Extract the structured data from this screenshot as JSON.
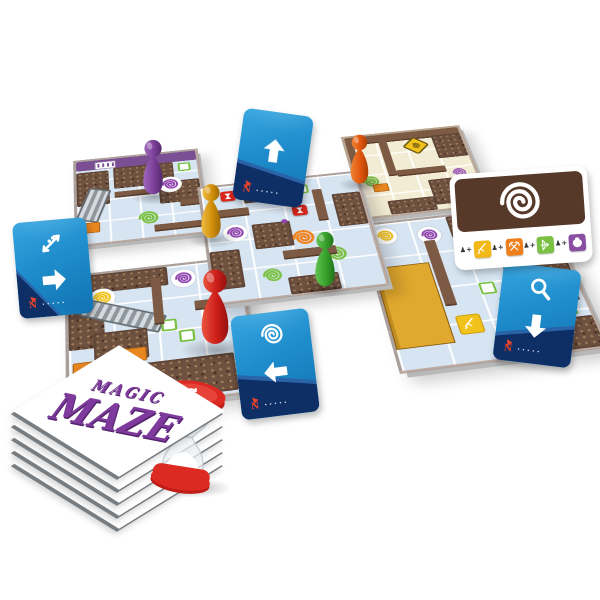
{
  "logo": {
    "line1": "MAGIC",
    "line2": "MAZE",
    "color": "#7e3a9c"
  },
  "palette": {
    "card_blue": "#1f8fd0",
    "card_navy": "#0e2f66",
    "tile_blue": "#d7e5f2",
    "tile_cream": "#f3ecd4",
    "wall_brown": "#7d5a44",
    "crowd_brown": "#6f5140",
    "swirl_purple": "#8e44ad",
    "swirl_green": "#7ac143",
    "swirl_orange": "#f0821e",
    "swirl_yellow": "#f2c21c",
    "hourglass_red": "#d9261c",
    "shop_gold": "#e0a82e",
    "timer_red": "#dc2a22",
    "logo_purple": "#7e3a9c"
  },
  "action_cards": [
    {
      "id": "move-up",
      "icons": [
        {
          "n": "arrow",
          "dir": 0
        }
      ],
      "compass": "N",
      "fine_print": "•••••",
      "x": 238,
      "y": 112,
      "w": 70,
      "h": 92,
      "rot": 8,
      "navy": "slope-right"
    },
    {
      "id": "escalator-move-right",
      "icons": [
        {
          "n": "escalator"
        },
        {
          "n": "arrow",
          "dir": 90
        }
      ],
      "compass": "N",
      "fine_print": "•••••",
      "x": 16,
      "y": 220,
      "w": 74,
      "h": 96,
      "rot": -5,
      "navy": "corner"
    },
    {
      "id": "search-move-down",
      "icons": [
        {
          "n": "magnifier"
        },
        {
          "n": "arrow",
          "dir": 180
        }
      ],
      "compass": "N",
      "fine_print": "•••••",
      "x": 498,
      "y": 266,
      "w": 78,
      "h": 98,
      "rot": 7,
      "navy": "slope-left"
    },
    {
      "id": "vortex-move-left",
      "icons": [
        {
          "n": "vortex"
        },
        {
          "n": "arrow",
          "dir": 270
        }
      ],
      "compass": "N",
      "fine_print": "•••••",
      "x": 236,
      "y": 312,
      "w": 78,
      "h": 104,
      "rot": -7,
      "navy": "slope-right"
    }
  ],
  "spell_card": {
    "x": 452,
    "y": 170,
    "w": 138,
    "h": 96,
    "rot": -4,
    "top_icon": "vortex",
    "brown": "#57392a",
    "prefix": "♟+",
    "items": [
      {
        "icon": "sword",
        "color": "#f2b818"
      },
      {
        "icon": "axes",
        "color": "#ee7f1b"
      },
      {
        "icon": "bow",
        "color": "#7ac143"
      },
      {
        "icon": "flask",
        "color": "#8a4fa3"
      }
    ]
  },
  "pawns": [
    {
      "name": "purple",
      "main": "#7b3f98",
      "light": "#a169bd",
      "dark": "#55286e",
      "x": 138,
      "y": 138,
      "w": 30,
      "h": 60
    },
    {
      "name": "orange",
      "main": "#e0560b",
      "light": "#f08335",
      "dark": "#aa3e04",
      "x": 346,
      "y": 133,
      "w": 27,
      "h": 54
    },
    {
      "name": "gold",
      "main": "#d28f0a",
      "light": "#eebd46",
      "dark": "#9e6a04",
      "x": 196,
      "y": 183,
      "w": 30,
      "h": 58
    },
    {
      "name": "green",
      "main": "#37a02c",
      "light": "#66c253",
      "dark": "#1f741a",
      "x": 310,
      "y": 230,
      "w": 30,
      "h": 60
    },
    {
      "name": "red",
      "main": "#cd1f1a",
      "light": "#ea5540",
      "dark": "#931110",
      "x": 193,
      "y": 268,
      "w": 44,
      "h": 80
    }
  ],
  "timer": {
    "icon": "cycle-arrows",
    "cap_color": "#dc2a22",
    "cap_dark": "#c01d18",
    "cap_light": "#e8433a",
    "sand_color": "#ffffff",
    "x": 150,
    "y": 380,
    "w": 74,
    "h": 116,
    "rot": 9
  },
  "stack": {
    "x": 6,
    "y": 336,
    "layers": 5,
    "square": 150,
    "step": 13,
    "inner_left": 38
  },
  "board": {
    "x": 62,
    "y": 96,
    "w": 480,
    "h": 335,
    "tiles": [
      {
        "id": "tile-purple-hall",
        "base": "blue",
        "x": 15,
        "y": 0,
        "w": 125,
        "h": 125,
        "z": 1,
        "features": [
          {
            "t": "band",
            "x": 0,
            "y": 0,
            "w": 100,
            "h": 12,
            "c": "#7a4f93"
          },
          {
            "t": "whitesign",
            "x": 15,
            "y": 2,
            "w": 16,
            "h": 8
          },
          {
            "t": "crowd",
            "x": 30,
            "y": 12,
            "w": 50,
            "h": 26
          },
          {
            "t": "crowd",
            "x": 66,
            "y": 36,
            "w": 34,
            "h": 26
          },
          {
            "t": "crowd",
            "x": 0,
            "y": 14,
            "w": 26,
            "h": 42
          },
          {
            "t": "escalator",
            "x": 4,
            "y": 36,
            "w": 15,
            "h": 36,
            "r": 18
          },
          {
            "t": "discswirl",
            "x": 66,
            "y": 30,
            "s": 24,
            "c": "#8e44ad"
          },
          {
            "t": "swirl",
            "x": 46,
            "y": 68,
            "s": 24,
            "c": "#7ac143"
          },
          {
            "t": "wall",
            "x": 30,
            "y": 42,
            "w": 34,
            "h": 6
          },
          {
            "t": "wall",
            "x": 82,
            "y": 60,
            "w": 18,
            "h": 6
          },
          {
            "t": "patch",
            "x": 3,
            "y": 76,
            "w": 13,
            "h": 10,
            "c": "#e8861f"
          },
          {
            "t": "wall",
            "x": 60,
            "y": 86,
            "w": 40,
            "h": 7
          },
          {
            "t": "chipg",
            "x": 84,
            "y": 14,
            "s": 9
          }
        ]
      },
      {
        "id": "tile-cream-hall",
        "base": "cream",
        "x": 300,
        "y": 5,
        "w": 125,
        "h": 125,
        "z": 1,
        "features": [
          {
            "t": "wall",
            "x": 0,
            "y": 0,
            "w": 100,
            "h": 9
          },
          {
            "t": "crowd",
            "x": 74,
            "y": 8,
            "w": 26,
            "h": 30
          },
          {
            "t": "signd",
            "x": 50,
            "y": 10,
            "s": 17
          },
          {
            "t": "wall",
            "x": 28,
            "y": 9,
            "w": 7,
            "h": 44
          },
          {
            "t": "wall",
            "x": 35,
            "y": 48,
            "w": 42,
            "h": 6
          },
          {
            "t": "swirl",
            "x": 3,
            "y": 50,
            "s": 21,
            "c": "#7ac143"
          },
          {
            "t": "swirl",
            "x": 80,
            "y": 52,
            "s": 17,
            "c": "#9b59b6"
          },
          {
            "t": "crowd",
            "x": 58,
            "y": 64,
            "w": 36,
            "h": 30
          },
          {
            "t": "patch",
            "x": 12,
            "y": 62,
            "w": 11,
            "h": 8,
            "c": "#e8861f"
          },
          {
            "t": "wall",
            "x": 0,
            "y": 9,
            "w": 6,
            "h": 36
          },
          {
            "t": "crowd",
            "x": 20,
            "y": 84,
            "w": 38,
            "h": 16
          }
        ]
      },
      {
        "id": "tile-center-cross",
        "base": "blue",
        "x": 140,
        "y": 62,
        "w": 160,
        "h": 160,
        "z": 3,
        "features": [
          {
            "t": "crowd",
            "x": 26,
            "y": 0,
            "w": 28,
            "h": 18
          },
          {
            "t": "hour",
            "x": 12,
            "y": 5,
            "s": 15
          },
          {
            "t": "hour",
            "x": 55,
            "y": 25,
            "s": 15
          },
          {
            "t": "crowd",
            "x": 82,
            "y": 18,
            "w": 18,
            "h": 30
          },
          {
            "t": "wall",
            "x": 0,
            "y": 22,
            "w": 28,
            "h": 6
          },
          {
            "t": "wall",
            "x": 70,
            "y": 12,
            "w": 6,
            "h": 28
          },
          {
            "t": "discswirl",
            "x": 10,
            "y": 36,
            "s": 24,
            "c": "#8e44ad"
          },
          {
            "t": "crowd",
            "x": 28,
            "y": 38,
            "w": 24,
            "h": 22
          },
          {
            "t": "swirl",
            "x": 50,
            "y": 46,
            "s": 26,
            "c": "#f0821e"
          },
          {
            "t": "swirl",
            "x": 68,
            "y": 64,
            "s": 24,
            "c": "#7ac143"
          },
          {
            "t": "swirl",
            "x": 28,
            "y": 76,
            "s": 22,
            "c": "#7ac143"
          },
          {
            "t": "crowd",
            "x": 0,
            "y": 58,
            "w": 18,
            "h": 32
          },
          {
            "t": "wall",
            "x": 44,
            "y": 64,
            "w": 32,
            "h": 6
          },
          {
            "t": "chipg",
            "x": 60,
            "y": 6,
            "s": 9
          },
          {
            "t": "crowd",
            "x": 44,
            "y": 86,
            "w": 30,
            "h": 14
          },
          {
            "t": "dot",
            "x": 47,
            "y": 36,
            "s": 6,
            "c": "#8e44ad"
          }
        ]
      },
      {
        "id": "tile-escalator-hall",
        "base": "blue",
        "x": 5,
        "y": 168,
        "w": 160,
        "h": 160,
        "z": 2,
        "features": [
          {
            "t": "crowd",
            "x": 0,
            "y": 0,
            "w": 58,
            "h": 15
          },
          {
            "t": "crowd",
            "x": 0,
            "y": 15,
            "w": 20,
            "h": 42
          },
          {
            "t": "discswirl",
            "x": 12,
            "y": 12,
            "s": 24,
            "c": "#f2c21c"
          },
          {
            "t": "discswirl",
            "x": 60,
            "y": 4,
            "s": 23,
            "c": "#8e44ad"
          },
          {
            "t": "escalator",
            "x": 6,
            "y": 28,
            "w": 46,
            "h": 11,
            "r": 24
          },
          {
            "t": "crowd",
            "x": 14,
            "y": 46,
            "w": 30,
            "h": 22
          },
          {
            "t": "chipg",
            "x": 52,
            "y": 42,
            "s": 10
          },
          {
            "t": "chipg",
            "x": 61,
            "y": 51,
            "s": 10
          },
          {
            "t": "patch",
            "x": 27,
            "y": 60,
            "w": 14,
            "h": 9,
            "c": "#e8861f"
          },
          {
            "t": "crowd",
            "x": 18,
            "y": 72,
            "w": 72,
            "h": 26
          },
          {
            "t": "wall",
            "x": 48,
            "y": 8,
            "w": 6,
            "h": 36
          },
          {
            "t": "wall",
            "x": 72,
            "y": 30,
            "w": 28,
            "h": 6
          },
          {
            "t": "patch",
            "x": 2,
            "y": 66,
            "w": 13,
            "h": 10,
            "c": "#e8861f"
          }
        ]
      },
      {
        "id": "tile-shop-hall",
        "base": "blue",
        "x": 292,
        "y": 142,
        "w": 185,
        "h": 185,
        "z": 2,
        "features": [
          {
            "t": "discswirl",
            "x": 5,
            "y": 3,
            "s": 23,
            "c": "#f2c21c"
          },
          {
            "t": "discswirl",
            "x": 28,
            "y": 6,
            "s": 23,
            "c": "#8e44ad"
          },
          {
            "t": "crowd",
            "x": 46,
            "y": 0,
            "w": 32,
            "h": 16
          },
          {
            "t": "patch",
            "x": 80,
            "y": 2,
            "w": 14,
            "h": 9,
            "c": "#e8861f"
          },
          {
            "t": "crowd",
            "x": 66,
            "y": 16,
            "w": 34,
            "h": 46
          },
          {
            "t": "shop",
            "x": 0,
            "y": 32,
            "w": 28,
            "h": 54
          },
          {
            "t": "wall",
            "x": 30,
            "y": 16,
            "w": 6,
            "h": 46
          },
          {
            "t": "chipg",
            "x": 50,
            "y": 50,
            "s": 11
          },
          {
            "t": "chipg",
            "x": 68,
            "y": 64,
            "s": 11
          },
          {
            "t": "itemsq",
            "x": 33,
            "y": 70,
            "s": 21,
            "icon": "sword"
          },
          {
            "t": "crowd",
            "x": 52,
            "y": 80,
            "w": 48,
            "h": 20
          },
          {
            "t": "wall",
            "x": 58,
            "y": 62,
            "w": 40,
            "h": 6
          },
          {
            "t": "chipg",
            "x": 86,
            "y": 70,
            "s": 11
          }
        ]
      }
    ]
  }
}
